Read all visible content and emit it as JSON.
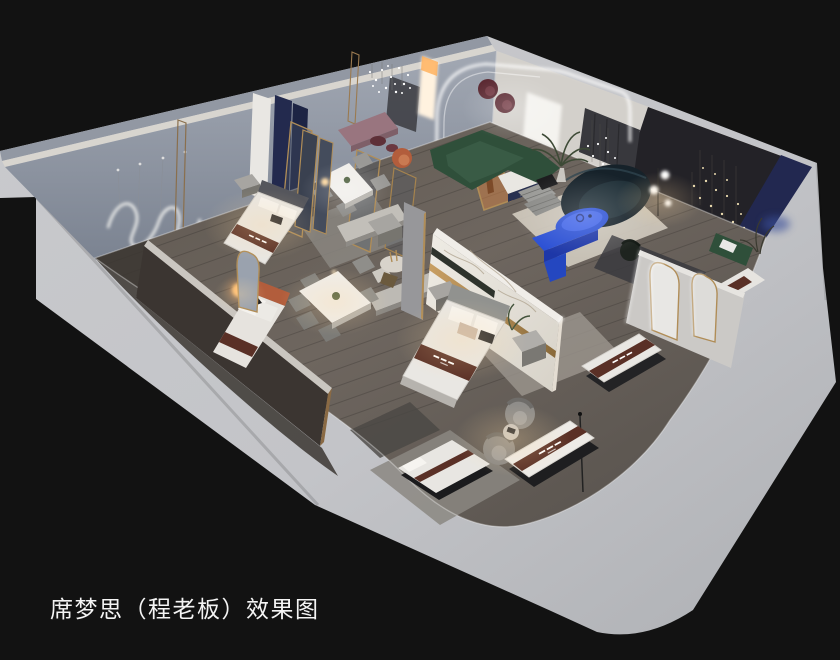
{
  "caption": {
    "text": "席梦思（程老板）效果图"
  },
  "scene": {
    "kind": "3D isometric cutaway interior rendering",
    "subject": "Simmons mattress showroom concept with bedrooms, dining sets, lounge and mattress display corridor",
    "rooms": [
      "bedroom-display-back-left",
      "bedroom-front-left",
      "central-bedroom-with-marble-wall",
      "dining-area",
      "lounge-living-area-with-arch",
      "dark-feature-room",
      "mattress-display-corridor"
    ],
    "notable_objects": [
      "wavy-neon-wall-art",
      "crystal-chandelier",
      "fairy-light-clusters",
      "green-modular-sofa",
      "navy-curved-sofa",
      "blue-oval-coffee-table",
      "blue-console",
      "marble-feature-wall",
      "gold-arch-mirrors",
      "mattress-displays-with-brand-runners",
      "tub-chairs",
      "dining-tables"
    ]
  },
  "palette": {
    "background": "#121212",
    "slab": "#c3c4c8",
    "back_wall": "#8f96a2",
    "wall_warm": "#d3d0cb",
    "dark_wall": "#232227",
    "floor_wood": "#6e665f",
    "accent_blue": "#2b50d4",
    "accent_blue_dark": "#1d37a8",
    "sofa_green": "#2f4f3a",
    "sofa_navy": "#16222a",
    "mauve": "#99757f",
    "rust": "#b25d3c",
    "maroon": "#5c2a33",
    "runner_brown": "#5a3026",
    "gold": "#b08d57",
    "navy_panel": "#222850",
    "led_white": "#ffffff",
    "lamp_warm": "#ffb45e",
    "caption_text": "#f4f4f4"
  }
}
